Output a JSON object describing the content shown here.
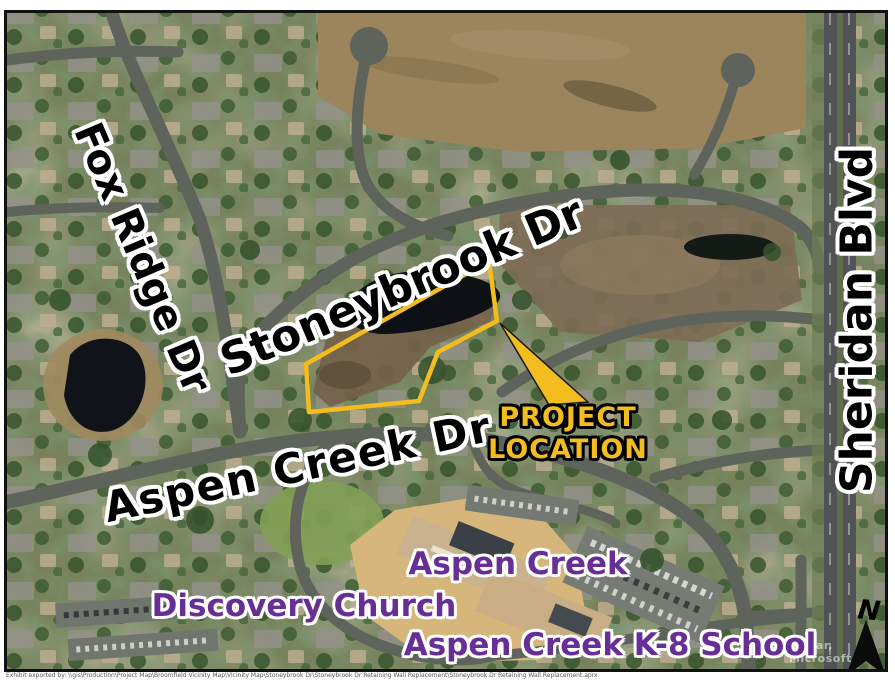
{
  "labels": {
    "fox_ridge": "Fox Ridge Dr",
    "stoneybrook": "Stoneybrook Dr",
    "aspen_creek_dr": "Aspen Creek Dr",
    "sheridan": "Sheridan Blvd",
    "north": "N"
  },
  "project": {
    "line1": "PROJECT",
    "line2": "LOCATION"
  },
  "places": {
    "aspen_creek": "Aspen Creek",
    "discovery_church": "Discovery Church",
    "k8_school": "Aspen Creek K-8 School"
  },
  "attribution": "Maxar, Microsoft",
  "caption": "Exhibit exported by: \\\\gis\\Production\\Project Map\\Broomfield Vicinity Map\\Vicinity Map\\Stoneybrook Dr\\Stoneybrook Dr Retaining Wall Replacement\\Stoneybrook Dr Retaining Wall Replacement.aprx",
  "colors": {
    "highlight": "#F3BC1F",
    "purple": "#672E95",
    "black": "#000000",
    "road": "#5E635B"
  }
}
